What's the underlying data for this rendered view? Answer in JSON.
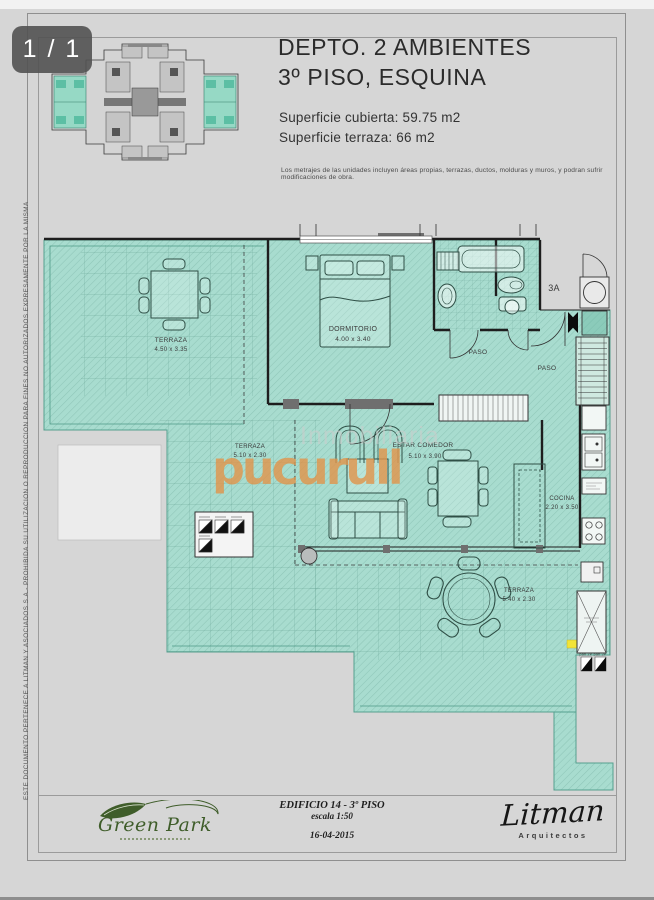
{
  "viewer": {
    "page_counter": "1 / 1"
  },
  "header": {
    "title_line1": "DEPTO. 2 AMBIENTES",
    "title_line2": "3º PISO, ESQUINA",
    "surface_line1": "Superficie cubierta: 59.75 m2",
    "surface_line2": "Superficie terraza: 66 m2",
    "disclaimer": "Los metrajes de las unidades incluyen áreas propias, terrazas, ductos, molduras y muros, y podran sufrir modificaciones de obra."
  },
  "plan": {
    "unit_label": "3A",
    "rooms": [
      {
        "name": "TERRAZA",
        "dims": "4.50 x 3.35"
      },
      {
        "name": "DORMITORIO",
        "dims": "4.00 x 3.40"
      },
      {
        "name": "PASO",
        "dims": ""
      },
      {
        "name": "PASO",
        "dims": ""
      },
      {
        "name": "TERRAZA",
        "dims": "5.10 x 2.30"
      },
      {
        "name": "ESTAR COMEDOR",
        "dims": "5.10 x 3.90"
      },
      {
        "name": "COCINA",
        "dims": "2.20 x 3.50"
      },
      {
        "name": "TERRAZA",
        "dims": "5.40 x 2.30"
      }
    ],
    "pan_labels": "pan 2P  pan 3P"
  },
  "watermark": {
    "line1": "Inmobiliaria",
    "line2": "pucurull"
  },
  "footer": {
    "logo_text": "Green Park",
    "plan_title": "EDIFICIO 14 - 3º PISO",
    "plan_scale": "escala 1:50",
    "plan_date": "16-04-2015",
    "signature": "Litman",
    "signature_sub": "Arquitectos"
  },
  "side_note": "ESTE DOCUMENTO PERTENECE A LITMAN Y ASOCIADOS S.A.-  PROHIBIDA SU UTILIZACION O REPRODUCCION PARA FINES NO AUTORIZADOS EXPRESAMENTE POR LA MISMA",
  "colors": {
    "floor_teal": "#a8dccf",
    "watermark_orange": "#e2944a",
    "highlight_yellow": "#f2e438",
    "logo_green": "#3f5d2a"
  }
}
